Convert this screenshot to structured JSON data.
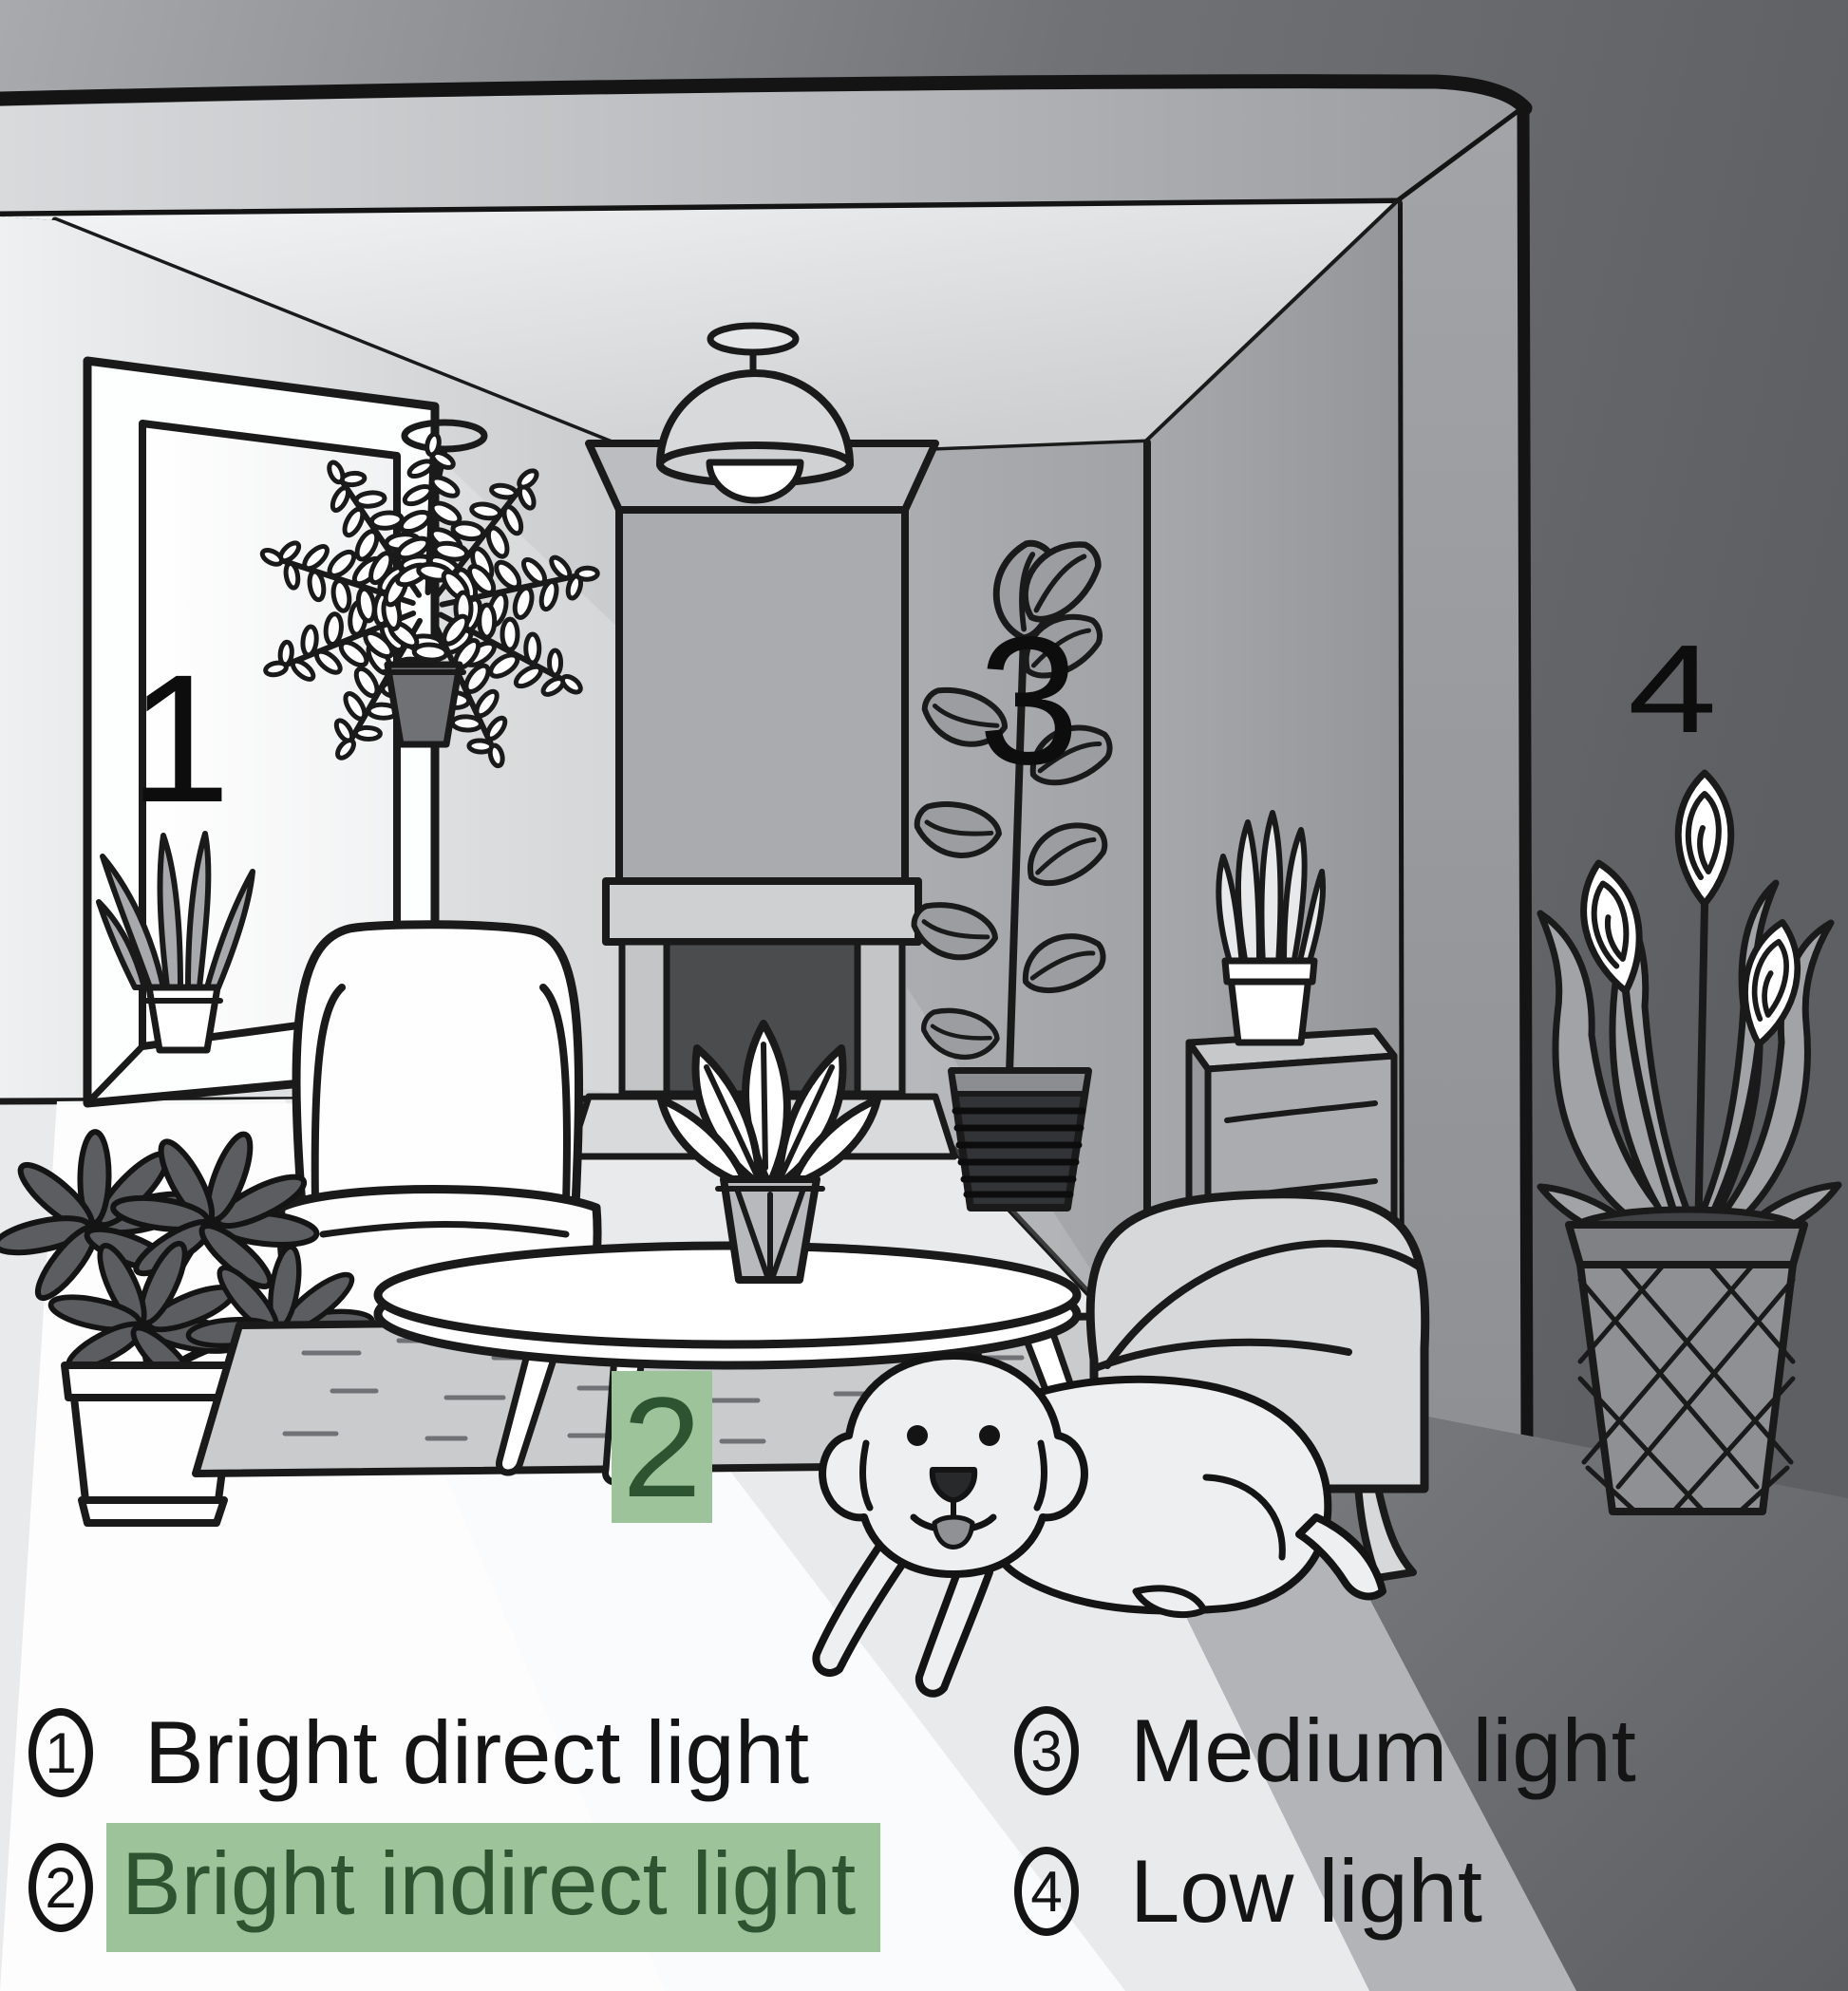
{
  "legend": {
    "items": [
      {
        "number": "1",
        "label": "Bright direct light",
        "highlighted": false
      },
      {
        "number": "2",
        "label": "Bright indirect light",
        "highlighted": true
      },
      {
        "number": "3",
        "label": "Medium light",
        "highlighted": false
      },
      {
        "number": "4",
        "label": "Low light",
        "highlighted": false
      }
    ]
  },
  "scene": {
    "zones": [
      {
        "number": "1",
        "highlighted": false
      },
      {
        "number": "2",
        "highlighted": true
      },
      {
        "number": "3",
        "highlighted": false
      },
      {
        "number": "4",
        "highlighted": false
      }
    ],
    "objects": [
      "window",
      "windowsill-plant",
      "hanging-fern",
      "schefflera-plant",
      "wingback-armchair",
      "fireplace",
      "pendant-lamp",
      "coffee-table",
      "table-plant",
      "rug",
      "dog",
      "rubber-plant",
      "snake-plant",
      "side-cabinet",
      "armchair",
      "peace-lily"
    ]
  },
  "colors": {
    "highlight_green_bg": "#9cc399",
    "highlight_green_text": "#2d5430",
    "outline_black": "#1a1a1a"
  }
}
